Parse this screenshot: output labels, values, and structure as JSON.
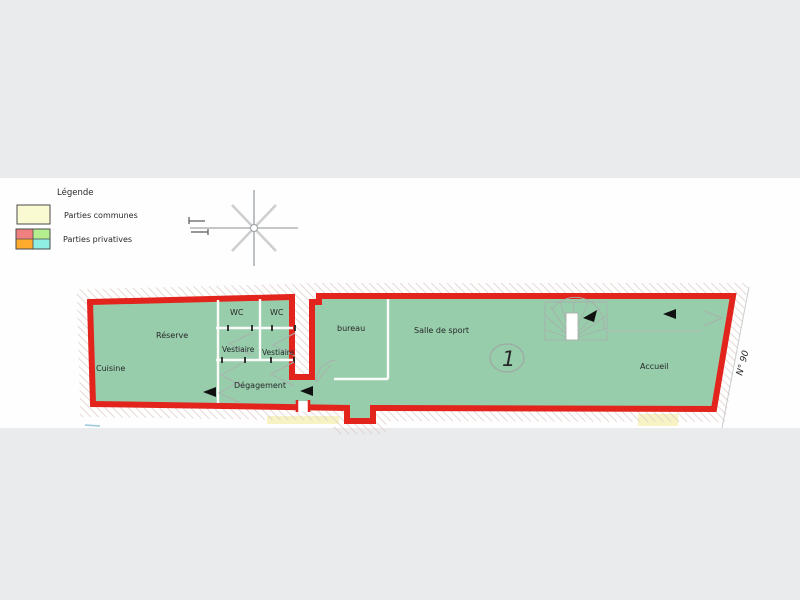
{
  "colors": {
    "background": "#E9EBED",
    "sheet": "#FEFEFE",
    "outline_red": "#E2241D",
    "room_green": "#97CDAB",
    "hatch_line": "#DCC9C5",
    "legend_yellow": "#FAFAD2",
    "legend_salmon": "#F08080",
    "legend_green": "#B5EE8E",
    "legend_orange": "#FFAB2E",
    "legend_cyan": "#8FEFE4"
  },
  "legend": {
    "title": "Légende",
    "items": [
      {
        "label": "Parties communes"
      },
      {
        "label": "Parties privatives"
      }
    ]
  },
  "plan": {
    "rooms": {
      "cuisine": "Cuisine",
      "reserve": "Réserve",
      "wc_left": "WC",
      "wc_right": "WC",
      "vestiaire_left": "Vestiaire",
      "vestiaire_right": "Vestiaire",
      "degagement": "Dégagement",
      "bureau": "bureau",
      "salle_de_sport": "Salle de sport",
      "accueil": "Accueil"
    },
    "unit_number": "1",
    "street_number": "N° 90"
  }
}
